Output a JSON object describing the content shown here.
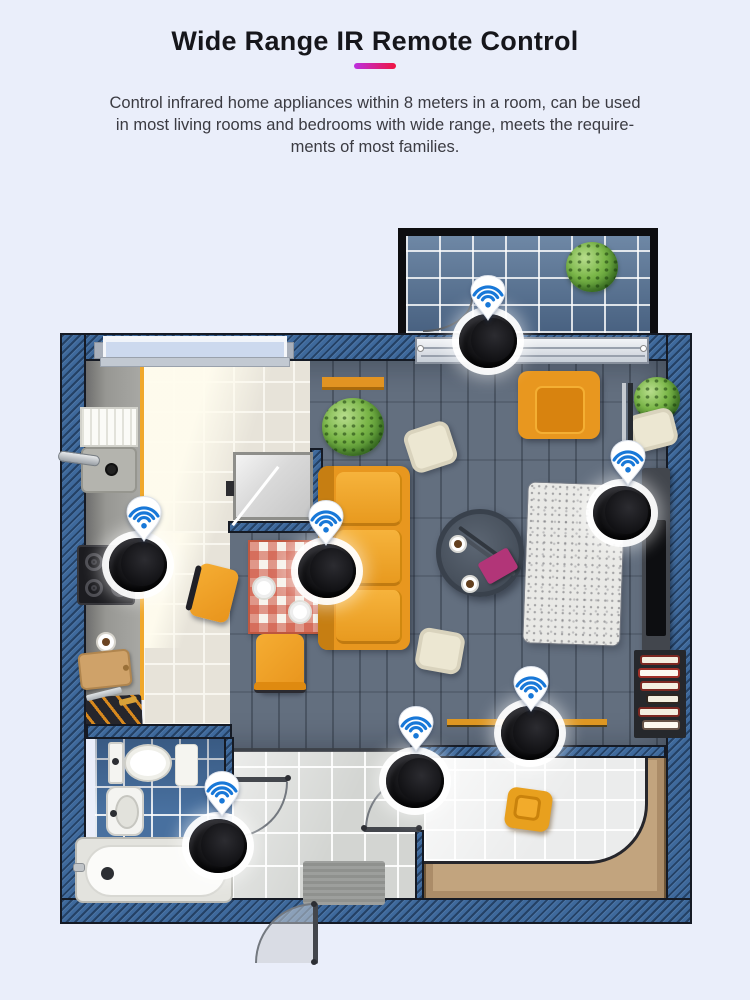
{
  "header": {
    "title": "Wide Range IR Remote Control",
    "description_lines": [
      "Control infrared home appliances within 8 meters in a room, can be used",
      "in most living rooms and bedrooms with wide range, meets the require-",
      "ments of most families."
    ],
    "accent_gradient_from": "#bb2fe0",
    "accent_gradient_to": "#f01440"
  },
  "floorplan": {
    "device_count": 7,
    "device_color": "#0b0b0d",
    "wifi_icon_color": "#1878d8",
    "wall_color": "#3e699c",
    "rooms": [
      "balcony",
      "kitchen",
      "dining area",
      "living room",
      "tv wall",
      "hallway",
      "bathroom",
      "bedroom"
    ],
    "devices": [
      {
        "room": "balcony",
        "x": 488,
        "y": 341,
        "wifi_x": 488,
        "wifi_y": 296
      },
      {
        "room": "kitchen-stove",
        "x": 138,
        "y": 565,
        "wifi_x": 144,
        "wifi_y": 517
      },
      {
        "room": "dining-table",
        "x": 327,
        "y": 571,
        "wifi_x": 326,
        "wifi_y": 521
      },
      {
        "room": "tv-wall",
        "x": 622,
        "y": 513,
        "wifi_x": 628,
        "wifi_y": 461
      },
      {
        "room": "living-room",
        "x": 530,
        "y": 733,
        "wifi_x": 531,
        "wifi_y": 687
      },
      {
        "room": "hallway",
        "x": 415,
        "y": 781,
        "wifi_x": 416,
        "wifi_y": 727
      },
      {
        "room": "bathroom",
        "x": 218,
        "y": 846,
        "wifi_x": 222,
        "wifi_y": 792
      }
    ]
  }
}
